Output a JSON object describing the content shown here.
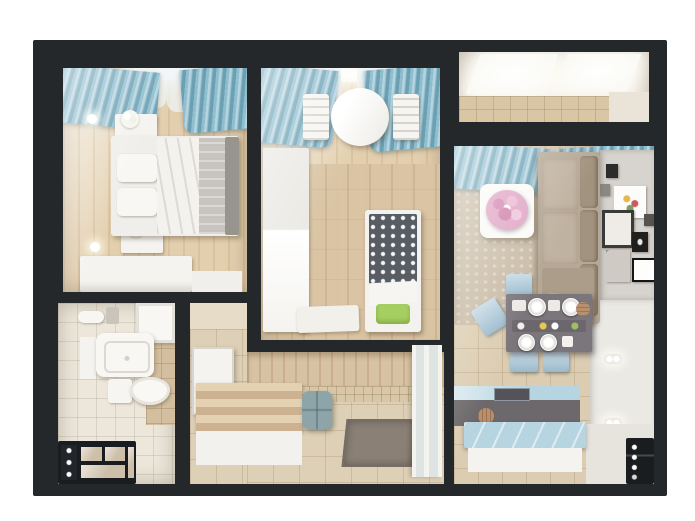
{
  "scene": {
    "kind": "3d-apartment-floor-plan-render",
    "view": "top-down cutaway"
  },
  "palette": {
    "background": "#ffffff",
    "wall": "#24282b",
    "wood_floor": "#e3cfae",
    "tile_floor": "#ded0b6",
    "bath_floor": "#ece7da",
    "beige_wall_tile": "#d3bf9f",
    "stone_wall": "#d9c3a3",
    "curtain_blue": "#85b8cb",
    "window_glow": "#fdfdf9",
    "white_furniture": "#f4f3ef",
    "bed_blanket_gray": "#c7c4bf",
    "bed_frame_gray": "#98948e",
    "crib_blanket_dark": "#585d63",
    "crib_pillow_green": "#a5cf60",
    "sofa_beige": "#b5a896",
    "sofa_cushion_dark": "#a2937e",
    "pillow_pink": "#c2a6a2",
    "carpet_beige": "#c9bba5",
    "flowers_pink": "#e0a4c4",
    "dining_table_gray": "#7b767b",
    "chair_blue": "#a9c8da",
    "counter_dark": "#6c686b",
    "counter_blue": "#b7d5e0",
    "gallery_wall_gray": "#d7d3ce",
    "white_wall": "#ebe9e4",
    "pouf_blue_gray": "#8da4a9",
    "doormat_gray": "#8a8076",
    "bench_wood": "#ccb290",
    "black_unit": "#1a1d20",
    "balcony_wall": "#efe9df"
  },
  "rooms": {
    "bedroom": {
      "items": [
        "window",
        "blue-curtains",
        "wall-sconces",
        "nightstands-with-flowers",
        "double-bed",
        "dresser"
      ]
    },
    "kids_room": {
      "items": [
        "window",
        "blue-curtains",
        "round-table",
        "two-chairs",
        "wardrobe",
        "crib-with-green-pillow",
        "rug"
      ]
    },
    "balcony": {
      "items": [
        "bright-window",
        "tiled-floor"
      ]
    },
    "living_kitchen": {
      "items": [
        "blue-curtains",
        "corner-sofa",
        "coffee-table",
        "pink-flower-bouquet",
        "gallery-wall-frames",
        "dining-table-set",
        "blue-chairs",
        "kitchen-counter-with-sink",
        "blue-island",
        "wall-sconces",
        "intercom-panel"
      ]
    },
    "bathroom": {
      "items": [
        "towel-rail",
        "bathtub",
        "sink-with-cabinet",
        "toilet",
        "black-storage-unit"
      ]
    },
    "hallway": {
      "items": [
        "white-door",
        "slatted-bench",
        "pouf",
        "doormat",
        "glass-door"
      ]
    }
  }
}
